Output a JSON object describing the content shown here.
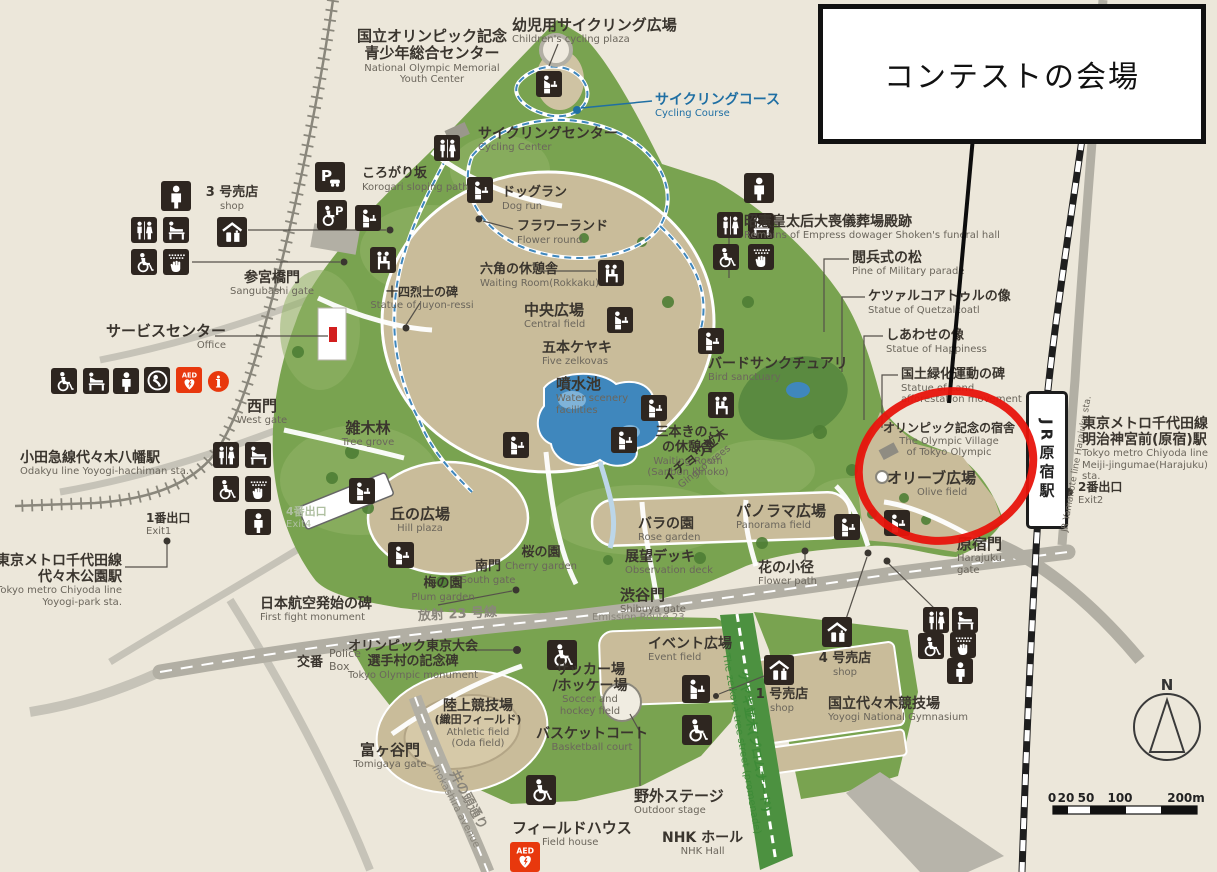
{
  "callout": {
    "text": "コンテストの会場"
  },
  "compass": {
    "label": "N"
  },
  "scale": {
    "ticks": [
      {
        "t": "0",
        "x": 1052
      },
      {
        "t": "20",
        "x": 1066
      },
      {
        "t": "50",
        "x": 1086
      },
      {
        "t": "100",
        "x": 1120
      },
      {
        "t": "200m",
        "x": 1186
      }
    ]
  },
  "stations": {
    "jr_box": "JR原宿駅",
    "jr_line_side": "JR Yamanote line Harajuku sta."
  },
  "colors": {
    "background": "#ece7da",
    "park_green": "#79a350",
    "field_tan": "#c9bc9a",
    "water_blue": "#3f87bd",
    "road_gray": "#b2afa4",
    "rail_black": "#1e1e1e",
    "highlight_red": "#e8140c",
    "icon_dark": "#2e2620",
    "emergency_red": "#e8380d",
    "cycling_blue": "#1f6fa3",
    "promenade_green": "#3d8b37"
  },
  "map": {
    "labels": [
      {
        "jp": "国立オリンピック記念\n青少年総合センター",
        "en": "National Olympic Memorial\nYouth Center",
        "x": 432,
        "y": 28,
        "c": "c",
        "js": 15
      },
      {
        "jp": "幼児用サイクリング広場",
        "en": "Children's cycling plaza",
        "x": 512,
        "y": 17,
        "c": "l",
        "js": 15
      },
      {
        "jp": "サイクリングコース",
        "en": "Cycling Course",
        "x": 655,
        "y": 92,
        "c": "l",
        "js": 14,
        "cls": "blue"
      },
      {
        "jp": "サイクリングセンター",
        "en": "Cycling Center",
        "x": 478,
        "y": 126,
        "c": "l",
        "js": 14
      },
      {
        "jp": "ころがり坂",
        "en": "Korogari sloping path",
        "x": 362,
        "y": 167,
        "c": "l",
        "js": 13
      },
      {
        "jp": "3 号売店",
        "en": "shop",
        "x": 232,
        "y": 186,
        "c": "c",
        "js": 13
      },
      {
        "jp": "参宮橋門",
        "en": "Sangubashi gate",
        "x": 272,
        "y": 270,
        "c": "c",
        "js": 14
      },
      {
        "jp": "十四烈士の碑",
        "en": "Statue of Juyon-ressi",
        "x": 422,
        "y": 286,
        "c": "c",
        "js": 12
      },
      {
        "jp": "サービスセンター",
        "en": "Office",
        "x": 106,
        "y": 323,
        "c": "l",
        "js": 15,
        "cls": "enr"
      },
      {
        "jp": "ドッグラン",
        "en": "Dog run",
        "x": 502,
        "y": 186,
        "c": "l",
        "js": 13
      },
      {
        "jp": "フラワーランド",
        "en": "Flower round",
        "x": 517,
        "y": 220,
        "c": "l",
        "js": 13
      },
      {
        "jp": "六角の休憩舎",
        "en": "Waiting Room(Rokkaku)",
        "x": 480,
        "y": 263,
        "c": "l",
        "js": 13
      },
      {
        "jp": "中央広場",
        "en": "Central field",
        "x": 524,
        "y": 302,
        "c": "l",
        "js": 15
      },
      {
        "jp": "五本ケヤキ",
        "en": "Five zelkovas",
        "x": 542,
        "y": 340,
        "c": "l",
        "js": 14
      },
      {
        "jp": "噴水池",
        "en": "Water scenery\nfacilities",
        "x": 556,
        "y": 376,
        "c": "l",
        "js": 15
      },
      {
        "jp": "三本きのこ\nの休憩舎",
        "en": "Waiting Room\n(Sanbon kinoko)",
        "x": 688,
        "y": 426,
        "c": "c",
        "js": 13
      },
      {
        "jp": "イチョウ並木",
        "en": "Gingko trees",
        "x": 700,
        "y": 448,
        "c": "c",
        "js": 13,
        "rot": -38
      },
      {
        "jp": "バードサンクチュアリ",
        "en": "Bird sanctuary",
        "x": 708,
        "y": 356,
        "c": "l",
        "js": 14
      },
      {
        "jp": "パノラマ広場",
        "en": "Panorama field",
        "x": 736,
        "y": 503,
        "c": "l",
        "js": 15
      },
      {
        "jp": "バラの園",
        "en": "Rose garden",
        "x": 638,
        "y": 516,
        "c": "l",
        "js": 14
      },
      {
        "jp": "展望デッキ",
        "en": "Observation deck",
        "x": 625,
        "y": 549,
        "c": "l",
        "js": 14
      },
      {
        "jp": "花の小径",
        "en": "Flower path",
        "x": 758,
        "y": 560,
        "c": "l",
        "js": 14
      },
      {
        "jp": "渋谷門",
        "en": "Shibuya gate",
        "x": 620,
        "y": 587,
        "c": "l",
        "js": 15
      },
      {
        "jp": "丘の広場",
        "en": "Hill plaza",
        "x": 420,
        "y": 506,
        "c": "c",
        "js": 15
      },
      {
        "jp": "桜の園",
        "en": "Cherry garden",
        "x": 541,
        "y": 546,
        "c": "c",
        "js": 13
      },
      {
        "jp": "南門",
        "en": "South gate",
        "x": 488,
        "y": 560,
        "c": "c",
        "js": 13
      },
      {
        "jp": "梅の園",
        "en": "Plum garden",
        "x": 443,
        "y": 577,
        "c": "c",
        "js": 13
      },
      {
        "jp": "雑木林",
        "en": "Tree grove",
        "x": 368,
        "y": 420,
        "c": "c",
        "js": 15
      },
      {
        "jp": "西門",
        "en": "West gate",
        "x": 262,
        "y": 398,
        "c": "c",
        "js": 15
      },
      {
        "jp": "小田急線代々木八幡駅",
        "en": "Odakyu line Yoyogi-hachiman sta.",
        "x": 20,
        "y": 450,
        "c": "l",
        "js": 14,
        "cls": "enr"
      },
      {
        "jp": "1番出口",
        "en": "Exit1",
        "x": 146,
        "y": 512,
        "c": "l",
        "js": 12
      },
      {
        "jp": "東京メトロ千代田線\n代々木公園駅",
        "en": "Tokyo metro Chiyoda line\nYoyogi-park sta.",
        "x": 122,
        "y": 553,
        "c": "r",
        "js": 14
      },
      {
        "jp": "4番出口",
        "en": "Exit4",
        "x": 286,
        "y": 506,
        "c": "l",
        "js": 11,
        "cls": "faint"
      },
      {
        "jp": "日本航空発始の碑",
        "en": "First fight monument",
        "x": 260,
        "y": 596,
        "c": "l",
        "js": 14
      },
      {
        "jp": "放射 23 号線",
        "x": 418,
        "y": 608,
        "c": "l",
        "js": 13,
        "cls": "road",
        "rot": -3
      },
      {
        "en": "Emission Route 23",
        "x": 592,
        "y": 612,
        "c": "l",
        "cls": "road"
      },
      {
        "jp": "交番",
        "x": 297,
        "y": 656,
        "c": "l",
        "js": 13
      },
      {
        "en": "Police\nBox",
        "x": 329,
        "y": 648,
        "c": "l",
        "es": 11
      },
      {
        "jp": "オリンピック東京大会\n選手村の記念碑",
        "en": "Tokyo Olympic monument",
        "x": 413,
        "y": 640,
        "c": "c",
        "js": 13
      },
      {
        "jp": "陸上競技場",
        "jp2": "(織田フィールド)",
        "en": "Athletic field\n(Oda field)",
        "x": 478,
        "y": 698,
        "c": "c",
        "js": 14
      },
      {
        "jp": "サッカー場\n/ホッケー場",
        "en": "Soccer and\nhockey field",
        "x": 590,
        "y": 662,
        "c": "c",
        "js": 14
      },
      {
        "jp": "バスケットコート",
        "en": "Basketball court",
        "x": 592,
        "y": 726,
        "c": "c",
        "js": 14
      },
      {
        "jp": "富ヶ谷門",
        "en": "Tomigaya gate",
        "x": 390,
        "y": 742,
        "c": "c",
        "js": 15
      },
      {
        "jp": "井の頭通り",
        "en": "Inokashira avenue",
        "x": 462,
        "y": 790,
        "c": "c",
        "js": 13,
        "rot": 62,
        "cls": "road"
      },
      {
        "jp": "フィールドハウス",
        "en": "Field house",
        "x": 512,
        "y": 820,
        "c": "l",
        "js": 15,
        "cls": "eni"
      },
      {
        "jp": "野外ステージ",
        "en": "Outdoor stage",
        "x": 634,
        "y": 788,
        "c": "l",
        "js": 15
      },
      {
        "jp": "NHK ホール",
        "en": "NHK Hall",
        "x": 662,
        "y": 830,
        "c": "l",
        "js": 14,
        "cls": "enc"
      },
      {
        "jp": "イベント広場",
        "en": "Event field",
        "x": 648,
        "y": 636,
        "c": "l",
        "js": 14
      },
      {
        "jp": "1 号売店",
        "en": "shop",
        "x": 782,
        "y": 688,
        "c": "c",
        "js": 13
      },
      {
        "jp": "4 号売店",
        "en": "shop",
        "x": 845,
        "y": 652,
        "c": "c",
        "js": 13
      },
      {
        "jp": "国立代々木競技場",
        "en": "Yoyogi National Gymnasium",
        "x": 828,
        "y": 696,
        "c": "l",
        "js": 14
      },
      {
        "jp": "ケヤキ並木(プロムナード)",
        "en": "The zelkova tree street (promenade)",
        "x": 748,
        "y": 730,
        "c": "c",
        "js": 12,
        "rot": 80,
        "cls": "green"
      },
      {
        "jp": "原宿門",
        "en": "Harajuku\ngate",
        "x": 957,
        "y": 536,
        "c": "l",
        "js": 15
      },
      {
        "jp": "東京メトロ千代田線\n明治神宮前(原宿)駅",
        "en": "Tokyo metro Chiyoda line\nMeiji-jingumae(Harajuku) sta.",
        "x": 1082,
        "y": 416,
        "c": "l",
        "js": 14
      },
      {
        "jp": "2番出口",
        "en": "Exit2",
        "x": 1078,
        "y": 481,
        "c": "l",
        "js": 12
      },
      {
        "jp": "昭憲皇太后大喪儀葬場殿跡",
        "en": "Remains of Empress dowager Shoken's funeral hall",
        "x": 744,
        "y": 214,
        "c": "l",
        "js": 14
      },
      {
        "jp": "閲兵式の松",
        "en": "Pine of Military parade",
        "x": 852,
        "y": 250,
        "c": "l",
        "js": 14
      },
      {
        "jp": "ケツァルコアトゥルの像",
        "en": "Statue of Quetzalcoatl",
        "x": 868,
        "y": 290,
        "c": "l",
        "js": 13
      },
      {
        "jp": "しあわせの像",
        "en": "Statue of Happiness",
        "x": 886,
        "y": 329,
        "c": "l",
        "js": 13
      },
      {
        "jp": "国土緑化運動の碑",
        "en": "Statue of Land\nafforestation movement",
        "x": 901,
        "y": 368,
        "c": "l",
        "js": 13
      },
      {
        "jp": "オリンピック記念の宿舎",
        "en": "The Olympic Village\nof Tokyo Olympic",
        "x": 883,
        "y": 422,
        "c": "l",
        "js": 12,
        "cls": "enc"
      },
      {
        "jp": "オリーブ広場",
        "en": "Olive field",
        "x": 887,
        "y": 470,
        "c": "l",
        "js": 15,
        "cls": "eni"
      }
    ],
    "icons": [
      {
        "t": "parking",
        "x": 330,
        "y": 177,
        "s": 30
      },
      {
        "t": "parking-acc",
        "x": 332,
        "y": 215,
        "s": 30
      },
      {
        "t": "fountain",
        "x": 368,
        "y": 218
      },
      {
        "t": "person",
        "x": 176,
        "y": 196,
        "s": 30
      },
      {
        "t": "toilets",
        "x": 144,
        "y": 230
      },
      {
        "t": "baby",
        "x": 176,
        "y": 230
      },
      {
        "t": "acc",
        "x": 144,
        "y": 262
      },
      {
        "t": "hands",
        "x": 176,
        "y": 262
      },
      {
        "t": "shop",
        "x": 232,
        "y": 232,
        "s": 30
      },
      {
        "t": "bench",
        "x": 383,
        "y": 260
      },
      {
        "t": "toilets",
        "x": 447,
        "y": 148
      },
      {
        "t": "fountain",
        "x": 549,
        "y": 84
      },
      {
        "t": "fountain",
        "x": 480,
        "y": 190
      },
      {
        "t": "bench",
        "x": 611,
        "y": 273
      },
      {
        "t": "fountain",
        "x": 620,
        "y": 320
      },
      {
        "t": "fountain",
        "x": 711,
        "y": 341
      },
      {
        "t": "person",
        "x": 759,
        "y": 188,
        "s": 30
      },
      {
        "t": "toilets",
        "x": 730,
        "y": 225
      },
      {
        "t": "baby",
        "x": 761,
        "y": 226
      },
      {
        "t": "acc",
        "x": 726,
        "y": 257
      },
      {
        "t": "hands",
        "x": 761,
        "y": 257
      },
      {
        "t": "fountain",
        "x": 624,
        "y": 440
      },
      {
        "t": "fountain",
        "x": 654,
        "y": 408
      },
      {
        "t": "bench",
        "x": 721,
        "y": 405
      },
      {
        "t": "toilets",
        "x": 226,
        "y": 455
      },
      {
        "t": "baby",
        "x": 258,
        "y": 455
      },
      {
        "t": "acc",
        "x": 226,
        "y": 489
      },
      {
        "t": "hands",
        "x": 258,
        "y": 489
      },
      {
        "t": "person",
        "x": 258,
        "y": 522
      },
      {
        "t": "fountain",
        "x": 362,
        "y": 491
      },
      {
        "t": "fountain",
        "x": 401,
        "y": 555
      },
      {
        "t": "fountain",
        "x": 516,
        "y": 445
      },
      {
        "t": "fountain",
        "x": 847,
        "y": 527
      },
      {
        "t": "fountain",
        "x": 897,
        "y": 523
      },
      {
        "t": "toilets",
        "x": 936,
        "y": 620
      },
      {
        "t": "baby",
        "x": 965,
        "y": 620
      },
      {
        "t": "acc",
        "x": 931,
        "y": 646
      },
      {
        "t": "hands",
        "x": 963,
        "y": 645
      },
      {
        "t": "person",
        "x": 960,
        "y": 671
      },
      {
        "t": "shop",
        "x": 779,
        "y": 670,
        "s": 30
      },
      {
        "t": "shop",
        "x": 837,
        "y": 632,
        "s": 30
      },
      {
        "t": "fountain",
        "x": 696,
        "y": 689,
        "s": 28
      },
      {
        "t": "acc",
        "x": 697,
        "y": 730,
        "s": 30
      },
      {
        "t": "acc",
        "x": 562,
        "y": 655,
        "s": 30
      },
      {
        "t": "acc",
        "x": 541,
        "y": 790,
        "s": 30
      },
      {
        "t": "acc",
        "x": 64,
        "y": 381
      },
      {
        "t": "baby",
        "x": 96,
        "y": 381
      },
      {
        "t": "person",
        "x": 126,
        "y": 381
      },
      {
        "t": "nursing",
        "x": 157,
        "y": 380
      },
      {
        "t": "aed",
        "x": 189,
        "y": 380
      },
      {
        "t": "info",
        "x": 218,
        "y": 381
      },
      {
        "t": "aed",
        "x": 525,
        "y": 857,
        "s": 30
      }
    ]
  }
}
